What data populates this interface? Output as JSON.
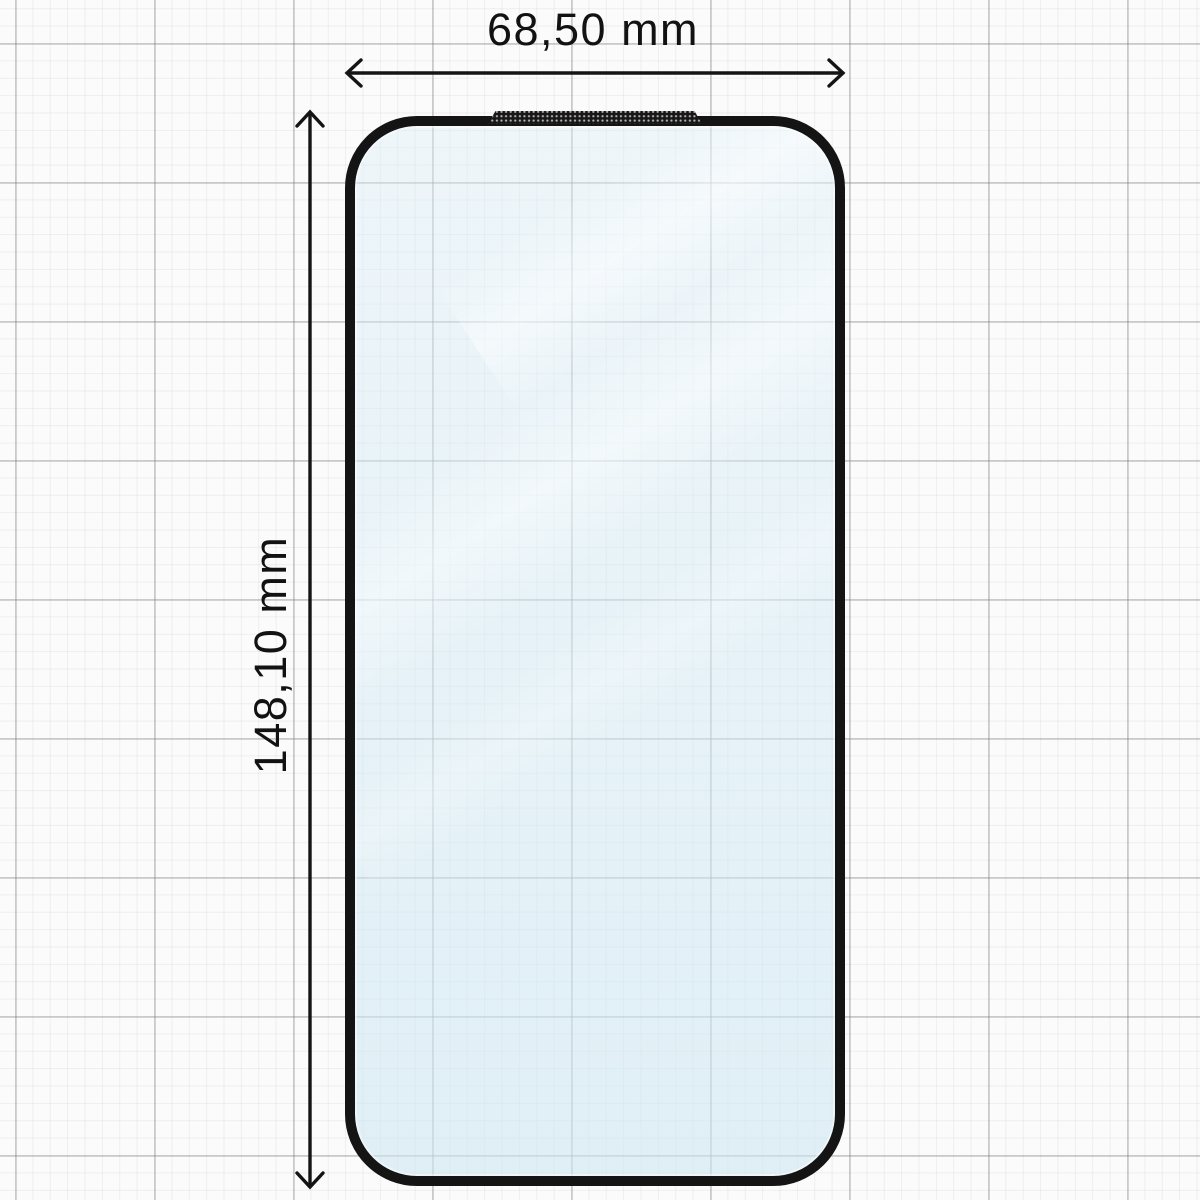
{
  "diagram": {
    "subject": "tempered-glass-screen-protector",
    "width_dimension": {
      "label": "68,50 mm",
      "value": "68,50",
      "unit": "mm"
    },
    "height_dimension": {
      "label": "148,10 mm",
      "value": "148,10",
      "unit": "mm"
    },
    "icons": {
      "width_arrow": "double-headed-horizontal-arrow-icon",
      "height_arrow": "double-headed-vertical-arrow-icon",
      "speaker_mesh": "speaker-mesh-cutout"
    },
    "colors": {
      "outline": "#141414",
      "glass_tint": "#e6f1f7",
      "reflection": "#ffffff",
      "background": "#fbfbfb",
      "grid_minor": "#ececec",
      "grid_major": "#c7c7c7",
      "text": "#121212"
    }
  }
}
